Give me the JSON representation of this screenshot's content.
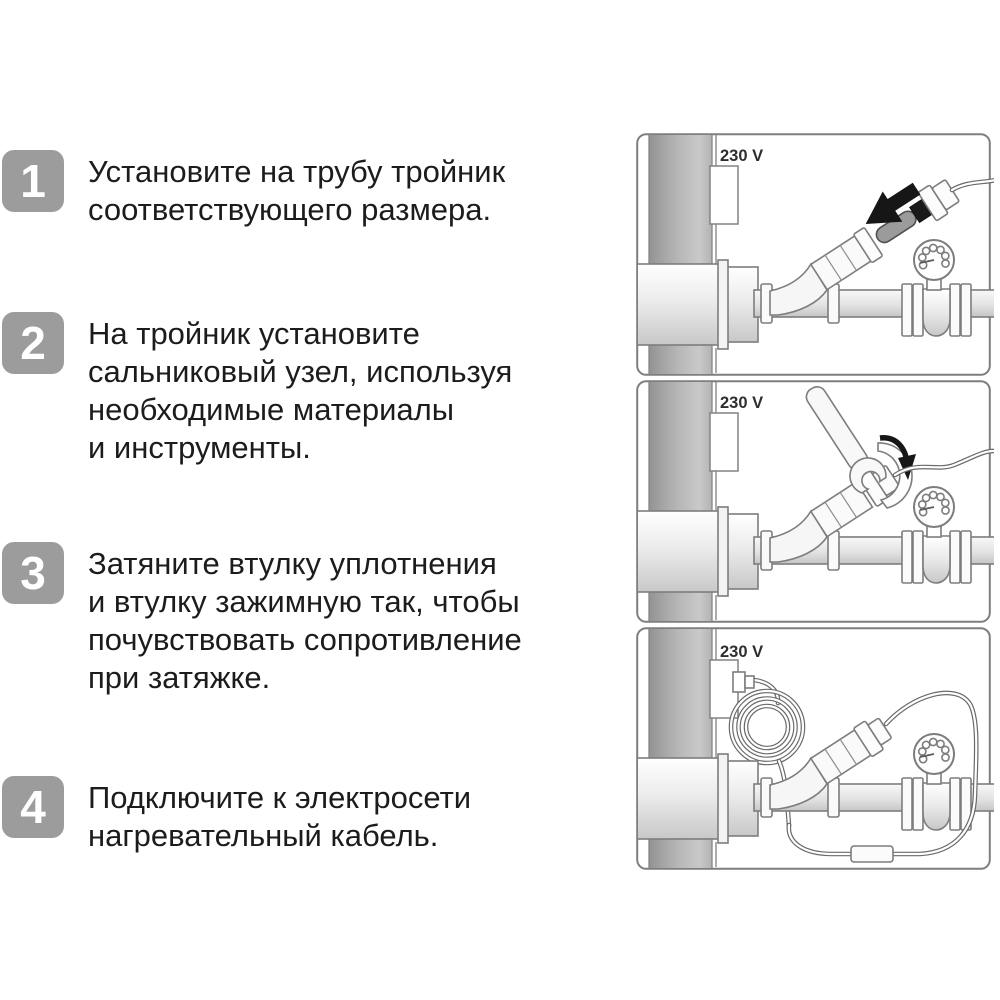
{
  "steps": [
    {
      "number": "1",
      "text": "Установите на трубу тройник\nсоответствующего размера."
    },
    {
      "number": "2",
      "text": "На тройник установите\nсальниковый узел, используя\nнеобходимые материалы\nи инструменты."
    },
    {
      "number": "3",
      "text": "Затяните втулку уплотнения\nи втулку зажимную так, чтобы\nпочувствовать сопротивление\nпри затяжке."
    },
    {
      "number": "4",
      "text": "Подключите к электросети\nнагревательный кабель."
    }
  ],
  "panels": [
    {
      "voltage_label": "230 V"
    },
    {
      "voltage_label": "230 V"
    },
    {
      "voltage_label": "230 V"
    }
  ],
  "colors": {
    "badge": "#9c9c9c",
    "badge_text": "#ffffff",
    "body_text": "#1c1c1c",
    "panel_border": "#7e7e7e",
    "diagram_outline": "#7d7d7d",
    "riser_pipe_gray": "#a9a9a9",
    "cable_end_gray": "#9b9b9b",
    "arrow_black": "#161616"
  }
}
